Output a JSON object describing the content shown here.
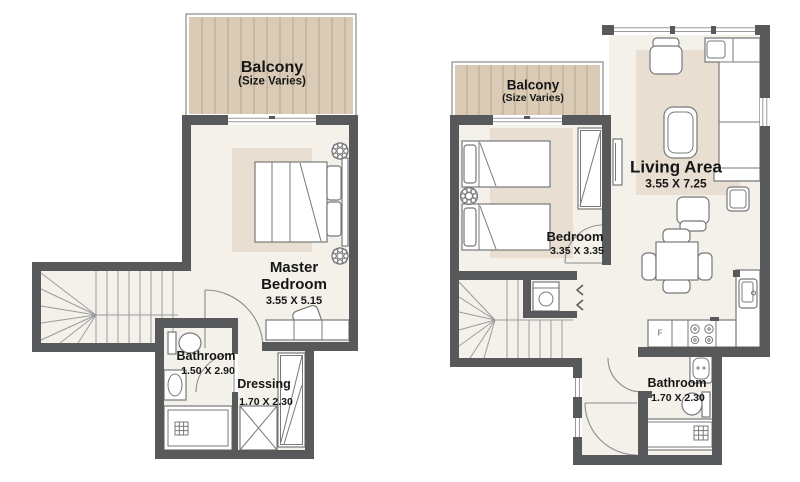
{
  "left_plan": {
    "balcony": {
      "title": "Balcony",
      "subtitle": "(Size Varies)"
    },
    "master_bedroom": {
      "name": "Master Bedroom",
      "dims": "3.55 X 5.15"
    },
    "bathroom": {
      "name": "Bathroom",
      "dims": "1.50 X 2.90"
    },
    "dressing": {
      "name": "Dressing",
      "dims": "1.70 X 2.30"
    }
  },
  "right_plan": {
    "balcony": {
      "title": "Balcony",
      "subtitle": "(Size Varies)"
    },
    "bedroom": {
      "name": "Bedroom",
      "dims": "3.35 X 3.35"
    },
    "living_area": {
      "name": "Living Area",
      "dims": "3.55 X 7.25"
    },
    "bathroom": {
      "name": "Bathroom",
      "dims": "1.70 X 2.30"
    },
    "kitchen": {
      "fridge_label": "F"
    }
  }
}
